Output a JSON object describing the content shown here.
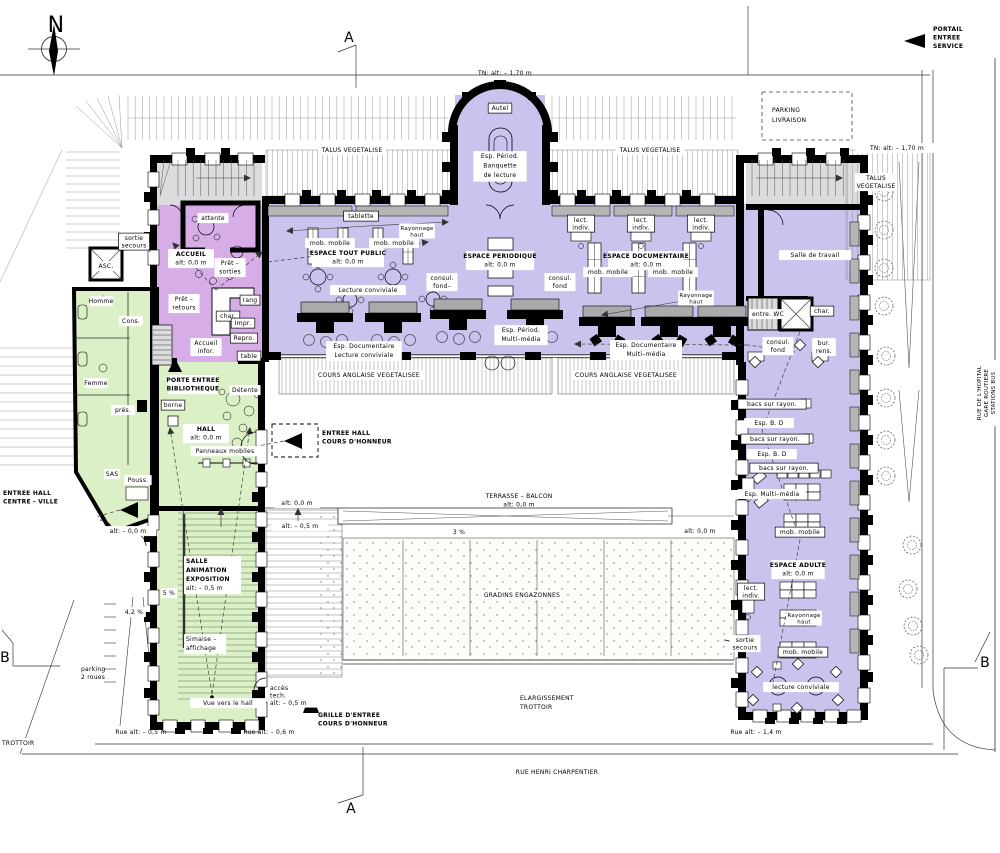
{
  "title": "Plan rez-de-chaussee - bibliotheque",
  "colors": {
    "zone_library": "#c9c3ee",
    "zone_accueil": "#d7ade8",
    "zone_hall": "#dcf0c8",
    "zone_technical": "#dcdcdc",
    "wall": "#000000",
    "shelf_gray": "#b5b5b5",
    "site_line": "#999999"
  },
  "labels": [
    {
      "n": "compass-label",
      "t": "N",
      "x": 56,
      "y": 32,
      "s": 22
    },
    {
      "n": "section-marker-a-top",
      "t": "A",
      "x": 349,
      "y": 42,
      "s": 14
    },
    {
      "n": "section-marker-a-bottom",
      "t": "A",
      "x": 351,
      "y": 813,
      "s": 14
    },
    {
      "n": "section-marker-b-left",
      "t": "B",
      "x": 5,
      "y": 662,
      "s": 14
    },
    {
      "n": "section-marker-b-right",
      "t": "B",
      "x": 985,
      "y": 667,
      "s": 14
    },
    {
      "n": "portail-entree-service",
      "L": [
        "PORTAIL",
        "ENTREE",
        "SERVICE"
      ],
      "x": 933,
      "y": 31,
      "b": 3,
      "a": "start",
      "lh": 8.5
    },
    {
      "n": "parking-livraison",
      "L": [
        "PARKING",
        "LIVRAISON"
      ],
      "x": 772,
      "y": 112,
      "a": "start",
      "lh": 10
    },
    {
      "n": "tn-alt-top-center",
      "t": "TN:    alt:  –  1,70 m",
      "x": 505,
      "y": 75
    },
    {
      "n": "tn-alt-top-right",
      "t": "TN:   alt:  –  1,70 m",
      "x": 897,
      "y": 150,
      "bg": 1
    },
    {
      "n": "talus-vegetalise-left",
      "t": "TALUS  VEGETALISE",
      "x": 352,
      "y": 152,
      "bg": 1
    },
    {
      "n": "talus-vegetalise-right",
      "t": "TALUS  VEGETALISE",
      "x": 650,
      "y": 152,
      "bg": 1
    },
    {
      "n": "talus-vegetalise-east",
      "L": [
        "TALUS",
        "VEGETALISE"
      ],
      "x": 876,
      "y": 180,
      "lh": 8,
      "bg": 1
    },
    {
      "n": "rue-de-lhopital",
      "L": [
        "RUE  DE  L'HOPITAL",
        "GARE  ROUTIERE",
        "STATIONS  BUS"
      ],
      "x": 981,
      "y": 393,
      "r": -90,
      "s": 5.5,
      "lh": 7,
      "bg": 1
    },
    {
      "n": "rue-henri-charpentier",
      "t": "RUE  HENRI  CHARPENTIER",
      "x": 557,
      "y": 774
    },
    {
      "n": "trottoir",
      "t": "TROTTOIR",
      "x": 2,
      "y": 745,
      "a": "start",
      "bg": 1
    },
    {
      "n": "parking-2-roues",
      "L": [
        "parking",
        "2  roues"
      ],
      "x": 81,
      "y": 671,
      "a": "start",
      "lh": 8
    },
    {
      "n": "pente-4-2",
      "t": "4,2 %",
      "x": 134,
      "y": 614,
      "bg": 1
    },
    {
      "n": "autel",
      "t": "Autel",
      "x": 500,
      "y": 110,
      "box": 1
    },
    {
      "n": "esp-period-banquette",
      "L": [
        "Esp.  Périod.",
        "Banquette",
        "de  lecture"
      ],
      "x": 500,
      "y": 158,
      "lh": 9.5,
      "bg": 1
    },
    {
      "n": "sortie-secours-nw",
      "L": [
        "sortie",
        "secours"
      ],
      "x": 134,
      "y": 240,
      "lh": 7.5,
      "box": 1
    },
    {
      "n": "asc",
      "t": "ASC.",
      "x": 106,
      "y": 268,
      "bg": 1
    },
    {
      "n": "attente",
      "t": "attente",
      "x": 213,
      "y": 220,
      "bg": 1
    },
    {
      "n": "accueil",
      "L": [
        "ACCUEIL",
        "alt:  0,0 m"
      ],
      "x": 191,
      "y": 256,
      "b": 1,
      "lh": 8.5,
      "bg": 1
    },
    {
      "n": "pret-sorties",
      "L": [
        "Prêt  –",
        "sorties"
      ],
      "x": 230,
      "y": 265,
      "lh": 8.5,
      "bg": 1
    },
    {
      "n": "pret-retours",
      "L": [
        "Prêt  –",
        "retours"
      ],
      "x": 184,
      "y": 301,
      "lh": 8.5,
      "bg": 1
    },
    {
      "n": "rang",
      "t": "rang",
      "x": 250,
      "y": 302,
      "box": 1
    },
    {
      "n": "char-accueil",
      "t": "char.",
      "x": 228,
      "y": 318,
      "box": 1
    },
    {
      "n": "impr",
      "t": "Impr.",
      "x": 243,
      "y": 325,
      "box": 1
    },
    {
      "n": "repro",
      "t": "Repro.",
      "x": 244,
      "y": 340,
      "box": 1
    },
    {
      "n": "accueil-infor",
      "L": [
        "Accueil",
        "infor."
      ],
      "x": 206,
      "y": 345,
      "lh": 8,
      "bg": 1
    },
    {
      "n": "table",
      "t": "table",
      "x": 249,
      "y": 358,
      "box": 1
    },
    {
      "n": "homme",
      "t": "Homme",
      "x": 101,
      "y": 303,
      "bg": 1
    },
    {
      "n": "cons",
      "t": "Cons.",
      "x": 131,
      "y": 323,
      "bg": 1
    },
    {
      "n": "femme",
      "t": "Femme",
      "x": 96,
      "y": 385,
      "bg": 1
    },
    {
      "n": "pres",
      "t": "prés.",
      "x": 123,
      "y": 412,
      "bg": 1
    },
    {
      "n": "borne",
      "t": "borne",
      "x": 173,
      "y": 407,
      "box": 1
    },
    {
      "n": "porte-entree-bibliotheque",
      "L": [
        "PORTE ENTREE",
        "BIBLIOTHEQUE"
      ],
      "x": 193,
      "y": 382,
      "b": 2,
      "lh": 8.5,
      "bg": 1
    },
    {
      "n": "detente",
      "t": "Détente",
      "x": 245,
      "y": 392,
      "bg": 1
    },
    {
      "n": "hall",
      "L": [
        "HALL",
        "alt:  0,0 m"
      ],
      "x": 206,
      "y": 431,
      "b": 1,
      "lh": 8.5,
      "bg": 1
    },
    {
      "n": "panneaux-mobiles",
      "t": "Panneaux  mobiles",
      "x": 225,
      "y": 453,
      "bg": 1
    },
    {
      "n": "sas",
      "t": "SAS",
      "x": 112,
      "y": 476,
      "bg": 1
    },
    {
      "n": "pouss",
      "t": "Pouss.",
      "x": 138,
      "y": 482,
      "bg": 1
    },
    {
      "n": "entree-hall-centre-ville",
      "L": [
        "ENTREE HALL",
        "CENTRE - VILLE"
      ],
      "x": 3,
      "y": 495,
      "b": 2,
      "a": "start",
      "lh": 8.5,
      "bg": 1
    },
    {
      "n": "alt-entree-cv",
      "t": "alt:  –  0,0 m",
      "x": 128,
      "y": 533,
      "bg": 1
    },
    {
      "n": "entree-hall-cours-honneur",
      "L": [
        "ENTREE HALL",
        "COURS D'HONNEUR"
      ],
      "x": 322,
      "y": 435,
      "b": 2,
      "a": "start",
      "lh": 8.5,
      "bg": 1
    },
    {
      "n": "tablette",
      "t": "tablette",
      "x": 361,
      "y": 218,
      "box": 1
    },
    {
      "n": "rayonnage-haut-tout-public",
      "L": [
        "Rayonnage",
        "haut"
      ],
      "x": 417,
      "y": 230,
      "s": 5.5,
      "lh": 6.5,
      "bg": 1
    },
    {
      "n": "mob-mobile-tp-1",
      "t": "mob.  mobile",
      "x": 330,
      "y": 245,
      "bg": 1
    },
    {
      "n": "mob-mobile-tp-2",
      "t": "mob.  mobile",
      "x": 394,
      "y": 245,
      "bg": 1
    },
    {
      "n": "espace-tout-public",
      "L": [
        "ESPACE TOUT PUBLIC",
        "alt:  0,0 m"
      ],
      "x": 348,
      "y": 255,
      "b": 1,
      "lh": 8.5,
      "bg": 1
    },
    {
      "n": "lecture-conviviale-tp",
      "t": "Lecture  conviviale",
      "x": 368,
      "y": 292,
      "bg": 1
    },
    {
      "n": "esp-doc-lecture-conviviale",
      "L": [
        "Esp.  Documentaire",
        "Lecture  conviviale"
      ],
      "x": 364,
      "y": 348,
      "lh": 9,
      "bg": 1
    },
    {
      "n": "consul-fond-left",
      "L": [
        "consul.",
        "fond–"
      ],
      "x": 442,
      "y": 280,
      "lh": 8,
      "bg": 1
    },
    {
      "n": "consul-fond-mid",
      "L": [
        "consul.",
        "fond"
      ],
      "x": 560,
      "y": 280,
      "lh": 8,
      "bg": 1
    },
    {
      "n": "espace-periodique",
      "L": [
        "ESPACE PERIODIQUE",
        "alt:  0,0 m"
      ],
      "x": 500,
      "y": 258,
      "b": 1,
      "lh": 8.5,
      "bg": 1
    },
    {
      "n": "esp-period-multimedia",
      "L": [
        "Esp.  Périod.",
        "Multi–média"
      ],
      "x": 521,
      "y": 332,
      "lh": 9,
      "bg": 1
    },
    {
      "n": "espace-documentaire",
      "L": [
        "ESPACE DOCUMENTAIRE",
        "alt:  0,0 m"
      ],
      "x": 646,
      "y": 258,
      "b": 1,
      "lh": 8.5,
      "bg": 1
    },
    {
      "n": "mob-mobile-doc-1",
      "t": "mob.  mobile",
      "x": 608,
      "y": 274,
      "bg": 1
    },
    {
      "n": "mob-mobile-doc-2",
      "t": "mob.  mobile",
      "x": 673,
      "y": 274,
      "bg": 1
    },
    {
      "n": "rayonnage-haut-doc",
      "L": [
        "Rayonnage",
        "haut"
      ],
      "x": 696,
      "y": 297,
      "s": 5.5,
      "lh": 6.5,
      "bg": 1
    },
    {
      "n": "esp-doc-multimedia",
      "L": [
        "Esp.  Documentaire",
        "Multi–média"
      ],
      "x": 646,
      "y": 347,
      "lh": 9,
      "bg": 1
    },
    {
      "n": "lect-indiv-1",
      "L": [
        "lect.",
        "indiv."
      ],
      "x": 581,
      "y": 222,
      "lh": 7.5,
      "box": 1
    },
    {
      "n": "lect-indiv-2",
      "L": [
        "lect.",
        "indiv."
      ],
      "x": 641,
      "y": 222,
      "lh": 7.5,
      "box": 1
    },
    {
      "n": "lect-indiv-3",
      "L": [
        "lect.",
        "indiv."
      ],
      "x": 701,
      "y": 222,
      "lh": 7.5,
      "box": 1
    },
    {
      "n": "salle-de-travail",
      "t": "Salle  de  travail",
      "x": 815,
      "y": 257,
      "bg": 1
    },
    {
      "n": "entre-wc",
      "t": "entre. WC",
      "x": 768,
      "y": 316,
      "bg": 1
    },
    {
      "n": "char-right",
      "t": "char.",
      "x": 822,
      "y": 313,
      "box": 1
    },
    {
      "n": "consul-fond-right",
      "L": [
        "consul.",
        "fond"
      ],
      "x": 778,
      "y": 344,
      "lh": 8,
      "bg": 1
    },
    {
      "n": "bur-rens",
      "L": [
        "bur.",
        "rens."
      ],
      "x": 824,
      "y": 345,
      "lh": 8,
      "bg": 1
    },
    {
      "n": "cours-anglaise-1",
      "t": "COURS  ANGLAISE  VEGETALISEE",
      "x": 369,
      "y": 377,
      "bg": 1
    },
    {
      "n": "cours-anglaise-2",
      "t": "COURS  ANGLAISE  VEGETALISEE",
      "x": 626,
      "y": 377,
      "bg": 1
    },
    {
      "n": "bacs-sur-rayon-1",
      "t": "bacs  sur  rayon.",
      "x": 772,
      "y": 406,
      "box": 1
    },
    {
      "n": "esp-bd-1",
      "t": "Esp.    B. D",
      "x": 769,
      "y": 425,
      "bg": 1
    },
    {
      "n": "bacs-sur-rayon-2",
      "t": "bacs  sur  rayon.",
      "x": 775,
      "y": 441,
      "box": 1
    },
    {
      "n": "esp-bd-2",
      "t": "Esp.    B. D",
      "x": 772,
      "y": 456,
      "bg": 1
    },
    {
      "n": "bacs-sur-rayon-3",
      "t": "bacs  sur  rayon.",
      "x": 784,
      "y": 470,
      "box": 1
    },
    {
      "n": "esp-multimedia-right",
      "t": "Esp.  Multi–média",
      "x": 772,
      "y": 496,
      "bg": 1
    },
    {
      "n": "mob-mobile-adulte-1",
      "t": "mob.  mobile",
      "x": 800,
      "y": 534,
      "box": 1
    },
    {
      "n": "espace-adulte",
      "L": [
        "ESPACE ADULTE",
        "alt:  0,0 m"
      ],
      "x": 798,
      "y": 567,
      "b": 1,
      "lh": 8.5,
      "bg": 1
    },
    {
      "n": "lect-indiv-adulte",
      "L": [
        "lect.",
        "indiv."
      ],
      "x": 751,
      "y": 590,
      "lh": 7.5,
      "box": 1
    },
    {
      "n": "rayonnage-haut-adulte",
      "L": [
        "Rayonnage",
        "haut"
      ],
      "x": 804,
      "y": 617,
      "s": 5.5,
      "lh": 6.5,
      "bg": 1
    },
    {
      "n": "sortie-secours-adulte",
      "L": [
        "sortie",
        "secours"
      ],
      "x": 745,
      "y": 642,
      "lh": 7.5,
      "bg": 1
    },
    {
      "n": "mob-mobile-adulte-2",
      "t": "mob.  mobile",
      "x": 803,
      "y": 654,
      "box": 1
    },
    {
      "n": "lecture-conviviale-adulte",
      "t": "lecture  conviviale",
      "x": 801,
      "y": 689,
      "bg": 1
    },
    {
      "n": "rue-alt-14",
      "t": "Rue  alt:  –  1,4 m",
      "x": 756,
      "y": 734
    },
    {
      "n": "terrasse-balcon",
      "L": [
        "TERRASSE  –  BALCON",
        "alt:  0,0 m"
      ],
      "x": 519,
      "y": 498,
      "lh": 8.5
    },
    {
      "n": "pente-3",
      "t": "3 %",
      "x": 459,
      "y": 534,
      "bg": 1
    },
    {
      "n": "alt-terrasse-right",
      "t": "alt:  0,0 m",
      "x": 700,
      "y": 533
    },
    {
      "n": "alt-ramp-0",
      "t": "alt:  0,0 m",
      "x": 297,
      "y": 505,
      "bg": 1
    },
    {
      "n": "alt-ramp-05",
      "t": "alt:  –  0,5 m",
      "x": 300,
      "y": 528,
      "bg": 1
    },
    {
      "n": "gradins-engazonnes",
      "t": "GRADINS  ENGAZONNES",
      "x": 522,
      "y": 597,
      "bg": 1
    },
    {
      "n": "elargissement-trottoir",
      "L": [
        "ELARGISSEMENT",
        "TROTTOIR"
      ],
      "x": 520,
      "y": 700,
      "a": "start",
      "lh": 9
    },
    {
      "n": "salle-animation-exposition",
      "L": [
        "SALLE",
        "ANIMATION",
        "EXPOSITION",
        "alt:  –  0,5 m"
      ],
      "x": 186,
      "y": 563,
      "b": 3,
      "a": "start",
      "lh": 9,
      "bg": 1
    },
    {
      "n": "pente-5",
      "t": "5 %",
      "x": 169,
      "y": 595,
      "bg": 1
    },
    {
      "n": "simaise-affichage",
      "L": [
        "Simaise  –",
        "affichage"
      ],
      "x": 186,
      "y": 641,
      "a": "start",
      "lh": 9,
      "bg": 1
    },
    {
      "n": "vue-vers-le-hall",
      "t": "Vue  vers  le  hall",
      "x": 228,
      "y": 705,
      "bg": 1
    },
    {
      "n": "acces-tech",
      "L": [
        "accès",
        "tech.",
        "alt:  –  0,5 m"
      ],
      "x": 270,
      "y": 690,
      "a": "start",
      "lh": 7.5,
      "bg": 1
    },
    {
      "n": "grille-entree-cours-honneur",
      "L": [
        "GRILLE D'ENTREE",
        "COURS D'HONNEUR"
      ],
      "x": 318,
      "y": 717,
      "b": 2,
      "a": "start",
      "lh": 8.5
    },
    {
      "n": "rue-alt-05",
      "t": "Rue  alt:  –  0,5 m",
      "x": 141,
      "y": 734
    },
    {
      "n": "rue-alt-06",
      "t": "Rue  alt:  –  0,6 m",
      "x": 269,
      "y": 734
    }
  ]
}
